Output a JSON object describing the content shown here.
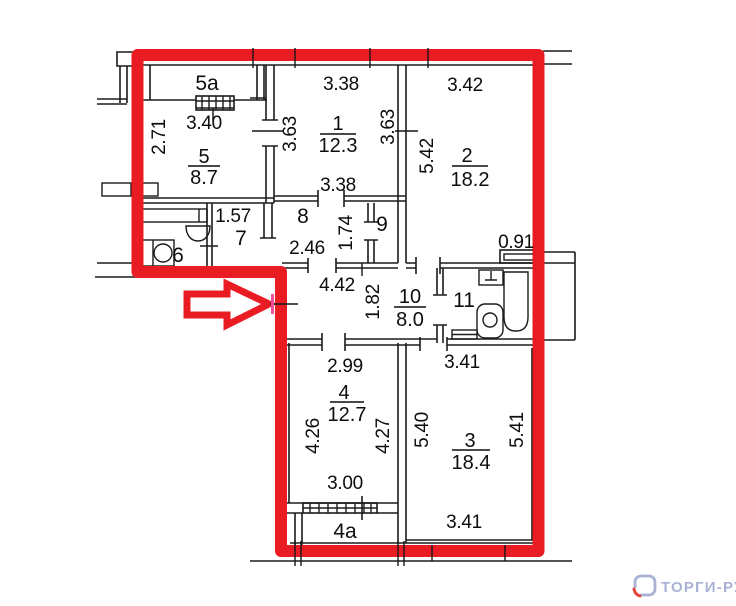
{
  "plan": {
    "type": "apartment-floor-plan",
    "highlight": {
      "outline_color": "#ea1c23",
      "arrow_direction": "right",
      "door_mark_color": "#f0509b"
    },
    "dims": [
      {
        "text": "3.40"
      },
      {
        "text": "2.71"
      },
      {
        "text": "3.38"
      },
      {
        "text": "3.63"
      },
      {
        "text": "3.63"
      },
      {
        "text": "3.38"
      },
      {
        "text": "3.42"
      },
      {
        "text": "5.42"
      },
      {
        "text": "1.57"
      },
      {
        "text": "2.46"
      },
      {
        "text": "1.74"
      },
      {
        "text": "0.91"
      },
      {
        "text": "4.42"
      },
      {
        "text": "1.82"
      },
      {
        "text": "3.41"
      },
      {
        "text": "2.99"
      },
      {
        "text": "4.26"
      },
      {
        "text": "4.27"
      },
      {
        "text": "5.40"
      },
      {
        "text": "5.41"
      },
      {
        "text": "3.00"
      },
      {
        "text": "3.41"
      }
    ],
    "room_tags": [
      {
        "text": "5a"
      },
      {
        "text": "6"
      },
      {
        "text": "7"
      },
      {
        "text": "8"
      },
      {
        "text": "9"
      },
      {
        "text": "11"
      },
      {
        "text": "4a"
      }
    ],
    "room_stats": [
      {
        "num": "5",
        "area": "8.7"
      },
      {
        "num": "1",
        "area": "12.3"
      },
      {
        "num": "2",
        "area": "18.2"
      },
      {
        "num": "10",
        "area": "8.0"
      },
      {
        "num": "4",
        "area": "12.7"
      },
      {
        "num": "3",
        "area": "18.4"
      }
    ]
  },
  "watermark": {
    "text": "ТОРГИ-РУ",
    "color": "#a9b2d4",
    "accent": "#e84338"
  }
}
